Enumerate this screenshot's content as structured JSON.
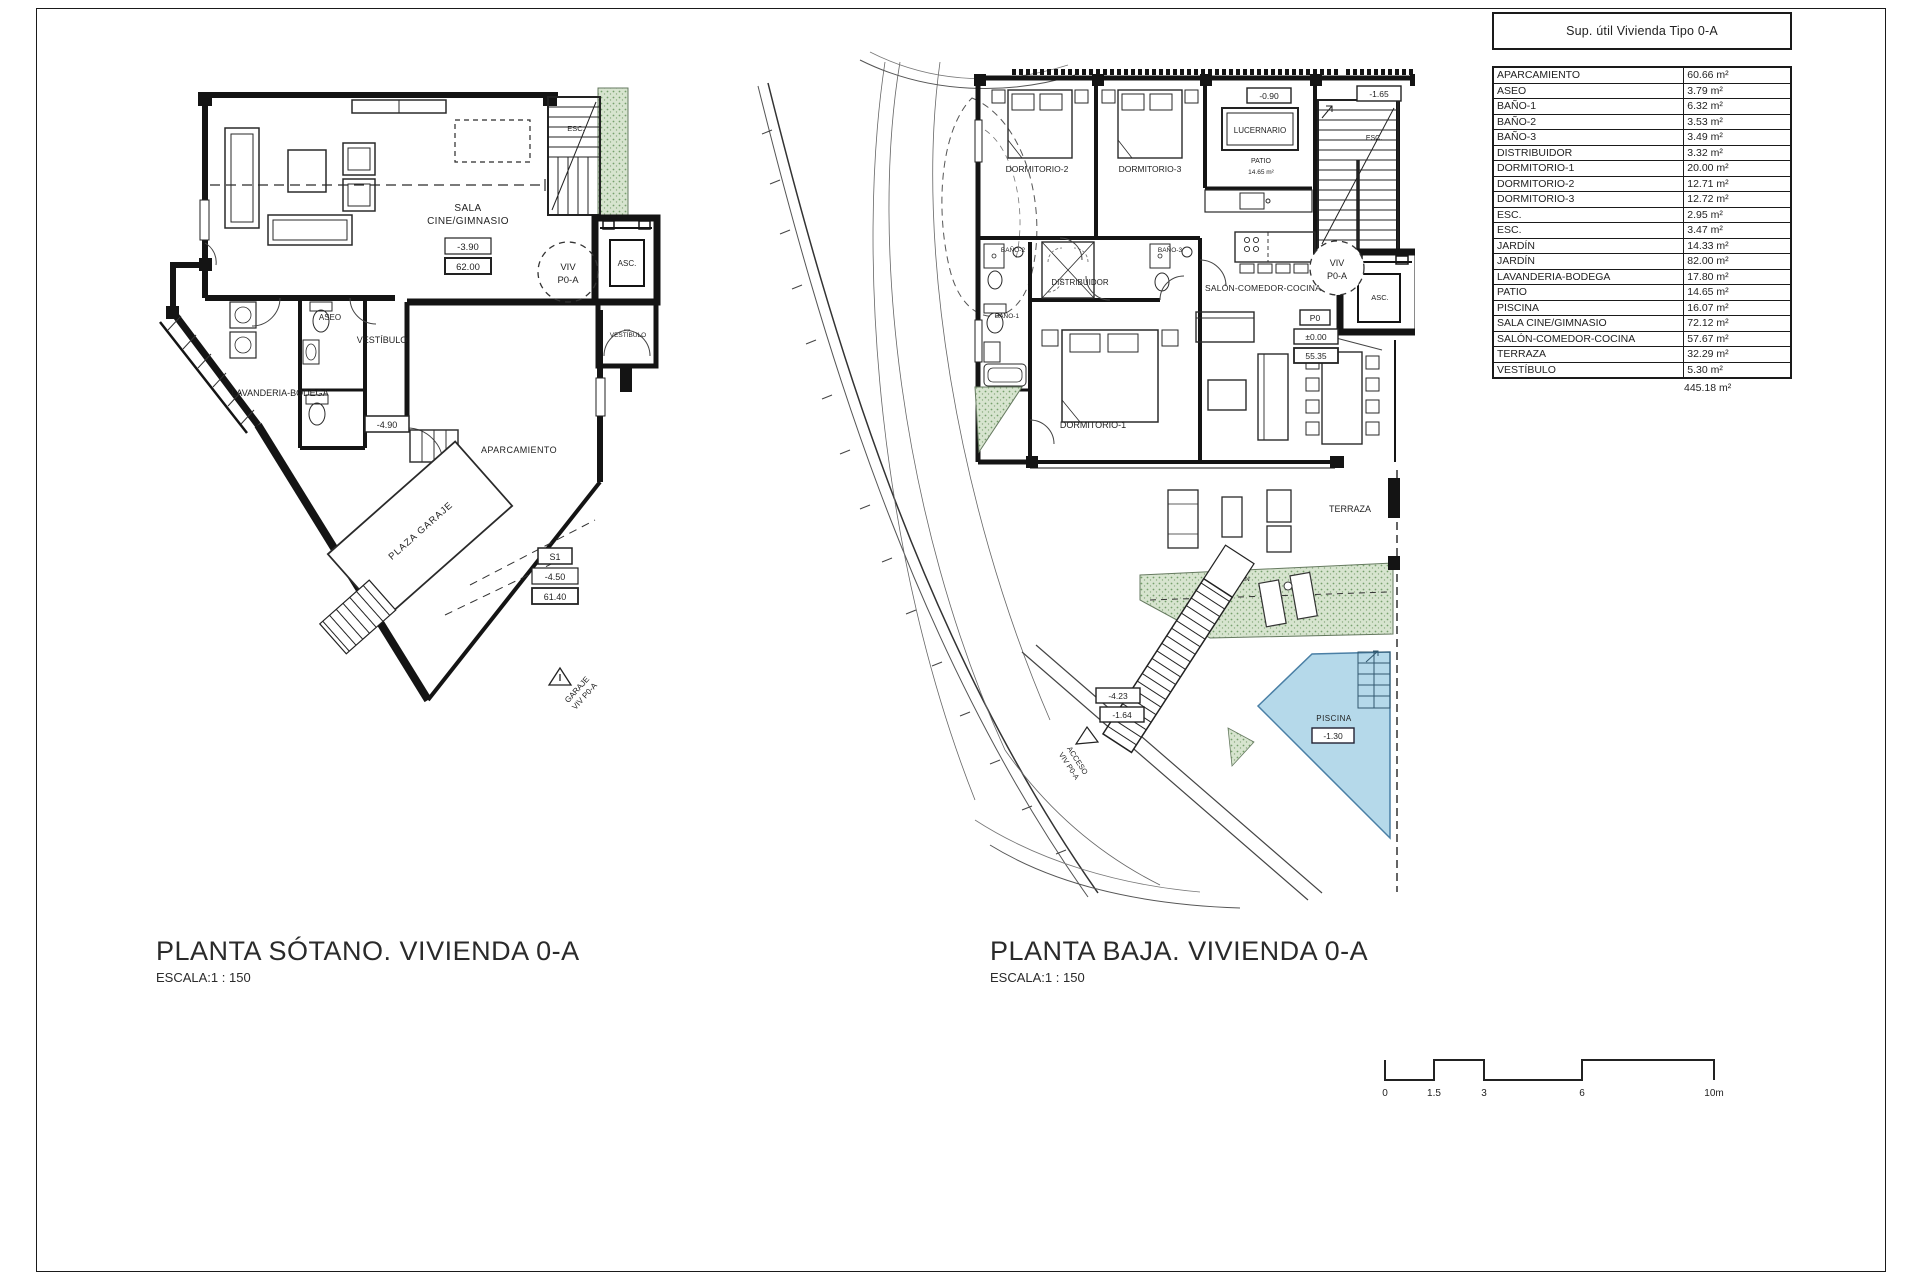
{
  "area_table": {
    "title": "Sup. útil Vivienda Tipo 0-A",
    "rows": [
      [
        "APARCAMIENTO",
        "60.66 m²"
      ],
      [
        "ASEO",
        "3.79 m²"
      ],
      [
        "BAÑO-1",
        "6.32 m²"
      ],
      [
        "BAÑO-2",
        "3.53 m²"
      ],
      [
        "BAÑO-3",
        "3.49 m²"
      ],
      [
        "DISTRIBUIDOR",
        "3.32 m²"
      ],
      [
        "DORMITORIO-1",
        "20.00 m²"
      ],
      [
        "DORMITORIO-2",
        "12.71 m²"
      ],
      [
        "DORMITORIO-3",
        "12.72 m²"
      ],
      [
        "ESC.",
        "2.95 m²"
      ],
      [
        "ESC.",
        "3.47 m²"
      ],
      [
        "JARDÍN",
        "14.33 m²"
      ],
      [
        "JARDÍN",
        "82.00 m²"
      ],
      [
        "LAVANDERIA-BODEGA",
        "17.80 m²"
      ],
      [
        "PATIO",
        "14.65 m²"
      ],
      [
        "PISCINA",
        "16.07 m²"
      ],
      [
        "SALA CINE/GIMNASIO",
        "72.12 m²"
      ],
      [
        "SALÓN-COMEDOR-COCINA",
        "57.67 m²"
      ],
      [
        "TERRAZA",
        "32.29 m²"
      ],
      [
        "VESTÍBULO",
        "5.30 m²"
      ]
    ],
    "total": "445.18 m²"
  },
  "plan_sotano": {
    "title": "PLANTA SÓTANO.  VIVIENDA 0-A",
    "scale": "ESCALA:1 : 150",
    "labels": {
      "sala1": "SALA",
      "sala2": "CINE/GIMNASIO",
      "elev_sala": "-3.90",
      "area_sala": "62.00",
      "esc": "ESC.",
      "asc": "ASC.",
      "aseo": "ASEO",
      "vestibulo": "VESTÍBULO",
      "vestibulo2": "VESTÍBULO",
      "lavanderia": "LAVANDERIA-BODEGA",
      "elev_vest": "-4.90",
      "aparcamiento": "APARCAMIENTO",
      "plaza": "PLAZA GARAJE",
      "s1": "S1",
      "elev_gar": "-4.50",
      "area_gar": "61.40",
      "viv": "VIV",
      "viv2": "P0-A",
      "garaje1": "GARAJE",
      "garaje2": "VIV P0-A"
    }
  },
  "plan_baja": {
    "title": "PLANTA BAJA. VIVIENDA 0-A",
    "scale": "ESCALA:1 : 150",
    "labels": {
      "dorm2": "DORMITORIO-2",
      "dorm3": "DORMITORIO-3",
      "lucernario": "LUCERNARIO",
      "patio": "PATIO",
      "patio_area": "14.65 m²",
      "elev_patio": "-0.90",
      "elev_esc": "-1.65",
      "esc": "ESC.",
      "asc": "ASC.",
      "viv": "VIV",
      "viv2": "P0-A",
      "bano1": "BAÑO-1",
      "bano2": "BAÑO-2",
      "bano3": "BAÑO-3",
      "distribuidor": "DISTRIBUIDOR",
      "dorm1": "DORMITORIO-1",
      "salon": "SALÓN-COMEDOR-COCINA",
      "p0": "P0",
      "elev_p0": "±0.00",
      "area_salon": "55.35",
      "terraza": "TERRAZA",
      "jardin": "JARDÍN",
      "piscina": "PISCINA",
      "elev_piscina": "-1.30",
      "elev_ext1": "-4.23",
      "elev_ext2": "-1.64",
      "acceso1": "ACCESO",
      "acceso2": "VIV P0-A"
    }
  },
  "scale_bar": {
    "labels": [
      "0",
      "1.5",
      "3",
      "6",
      "10m"
    ]
  },
  "colors": {
    "line": "#1a1a1a",
    "green": "#d7e4cf",
    "green_dot": "#76a06c",
    "pool": "#b5d9ea"
  }
}
